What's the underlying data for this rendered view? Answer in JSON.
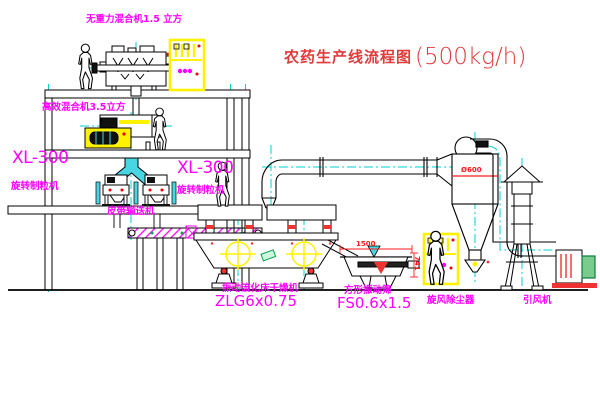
{
  "title": {
    "name_zh": "农药生产线流程图",
    "capacity": "(500kg/h)"
  },
  "labels": {
    "mixer_top": "无重力混合机1.5 立方",
    "mixer_mid": "高效混合机3.5立方",
    "granulator_left_model": "XL-300",
    "granulator_left_name": "旋转制粒机",
    "granulator_right_model": "XL-300",
    "granulator_right_name": "旋转制粒机",
    "conveyor": "皮带输送机",
    "dryer_name": "振动流化床干燥机",
    "dryer_model": "ZLG6x0.75",
    "screen_name": "方形振动筛",
    "screen_model": "FS0.6x1.5",
    "cyclone": "旋风除尘器",
    "fan": "引风机"
  },
  "dimensions": {
    "screen_length": "1500",
    "screen_height": "741",
    "cyclone_diameter": "Ø600"
  },
  "colors": {
    "label_magenta": "#ff00ff",
    "title_red": "#e03a3a",
    "dimension_red": "#ff1a1a",
    "centerline_cyan": "#00d2d2",
    "equipment_yellow": "#fff200",
    "chute_cyan": "#49d6e3",
    "motor_green": "#0b7a3b",
    "line_black": "#000000"
  }
}
